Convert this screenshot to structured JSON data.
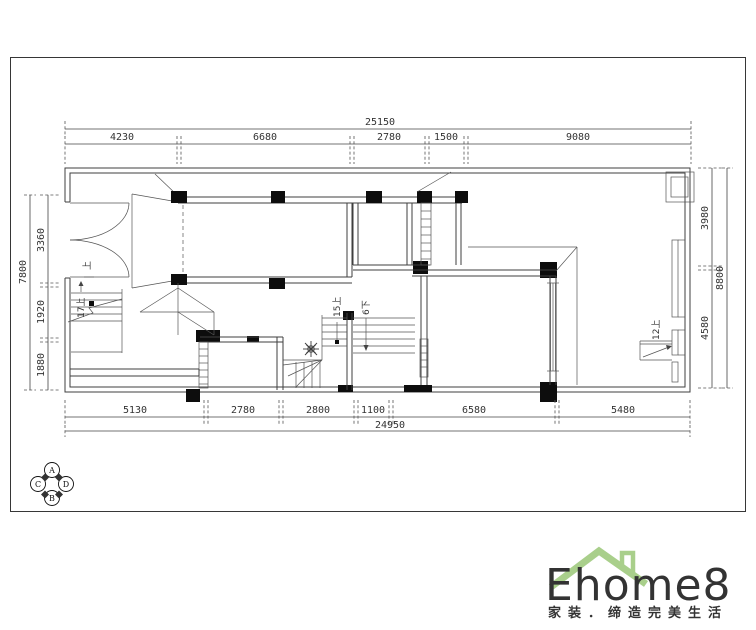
{
  "sheet": {
    "background": "#ffffff",
    "line_color": "#3f3f3f"
  },
  "dimensions": {
    "top": {
      "total": "25150",
      "segments": [
        "4230",
        "6680",
        "2780",
        "1500",
        "9080"
      ]
    },
    "bottom": {
      "total": "24950",
      "segments": [
        "5130",
        "2780",
        "2800",
        "1100",
        "6580",
        "5480"
      ]
    },
    "left": {
      "total": "7800",
      "segments": [
        "3360",
        "1920",
        "1880"
      ]
    },
    "right": {
      "total": "8800",
      "segments": [
        "3980",
        "4580"
      ]
    }
  },
  "stair_labels": {
    "left_flight": "17上",
    "center_up": "15上",
    "center_down": "6下",
    "right_flight": "12上",
    "entry_step": "上"
  },
  "index_symbol": {
    "top": "A",
    "bottom": "B",
    "left": "C",
    "right": "D"
  },
  "logo": {
    "brand": "Ehome8",
    "tagline": "家装．缔造完美生活",
    "brand_color": "#f2a074",
    "roof_color": "#a9cf8b",
    "tagline_color": "#b2d494"
  }
}
